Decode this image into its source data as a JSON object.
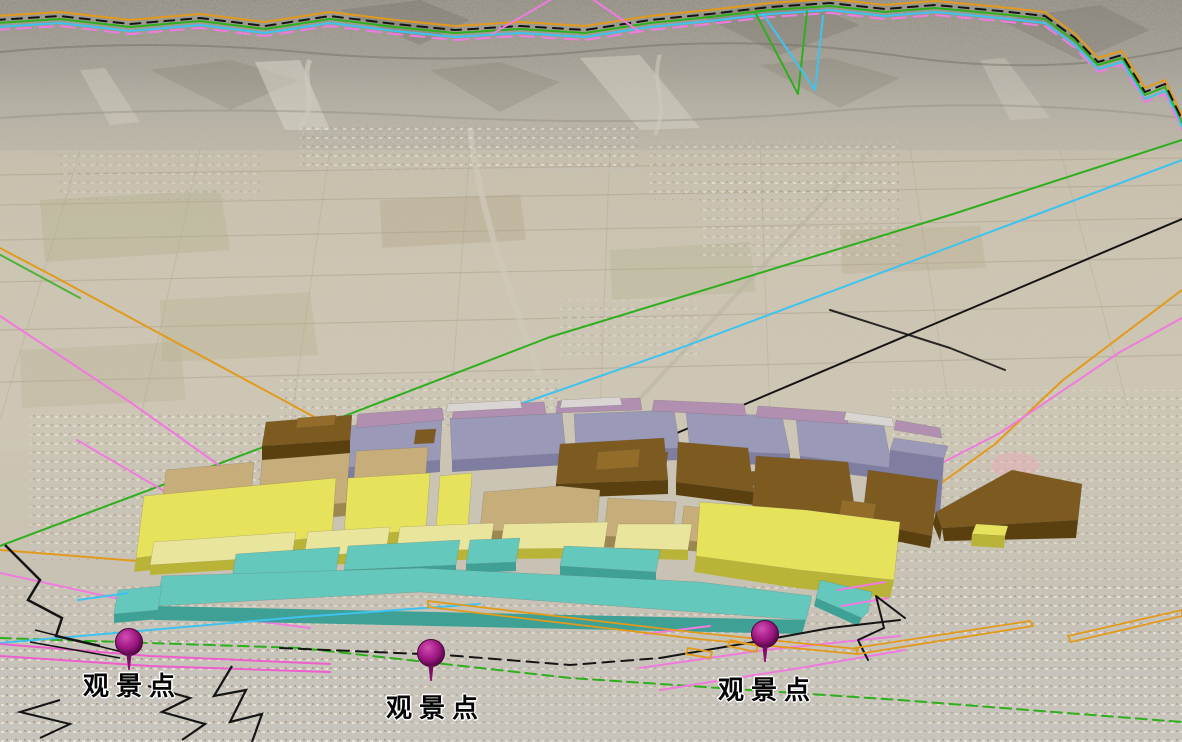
{
  "markers": [
    {
      "id": "viewpoint-1",
      "label": "观景点"
    },
    {
      "id": "viewpoint-2",
      "label": "观景点"
    },
    {
      "id": "viewpoint-3",
      "label": "观景点"
    }
  ],
  "palette": {
    "pin_fill": "#8e1077",
    "pin_highlight": "#d24fb2",
    "label_color": "#050505",
    "zone_yellow": "#e7e25c",
    "zone_yellow_light": "#e9e59c",
    "zone_yellow_side": "#b9b438",
    "zone_tan": "#c6ad79",
    "zone_tan_side": "#9c8751",
    "zone_brown": "#7d5a20",
    "zone_brown_side": "#5a400e",
    "zone_brown_light": "#936c2a",
    "zone_lavender": "#9b99b8",
    "zone_lavender_side": "#7f7da0",
    "zone_mauve": "#b18fb0",
    "zone_gray": "#d8d5d3",
    "zone_teal": "#64c8bc",
    "zone_teal_side": "#3fa095",
    "line_green": "#2fae1e",
    "line_cyan": "#3fc3ee",
    "line_orange": "#e29a1c",
    "line_pink": "#f07ade",
    "line_pink_bold": "#ee5ecd",
    "line_black": "#141414"
  }
}
